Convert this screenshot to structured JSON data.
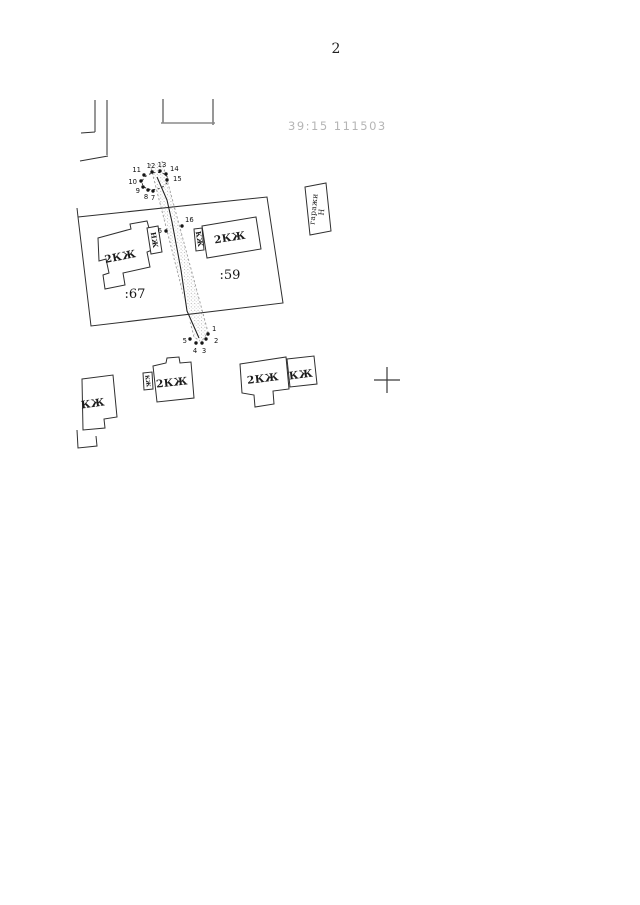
{
  "page": {
    "number": "2"
  },
  "map": {
    "quarter_label": "39:15 111503",
    "parcel_left_id": ":67",
    "parcel_right_id": ":59",
    "buildings": {
      "b67": "2КЖ",
      "b67_annex": "НЖ",
      "b59": "2КЖ",
      "b59_annex": "КЖ",
      "garage": "гаражи",
      "garage_mark": "Н",
      "sw": "2КЖ",
      "sw_annex": "КЖ",
      "se": "2КЖ",
      "se_annex": "КЖ",
      "w": "КЖ"
    },
    "points": {
      "p1": "1",
      "p2": "2",
      "p3": "3",
      "p4": "4",
      "p5": "5",
      "p6": "6",
      "p7": "7",
      "p8": "8",
      "p9": "9",
      "p10": "10",
      "p11": "11",
      "p12": "12",
      "p13": "13",
      "p14": "14",
      "p15": "15",
      "p16": "16"
    }
  }
}
